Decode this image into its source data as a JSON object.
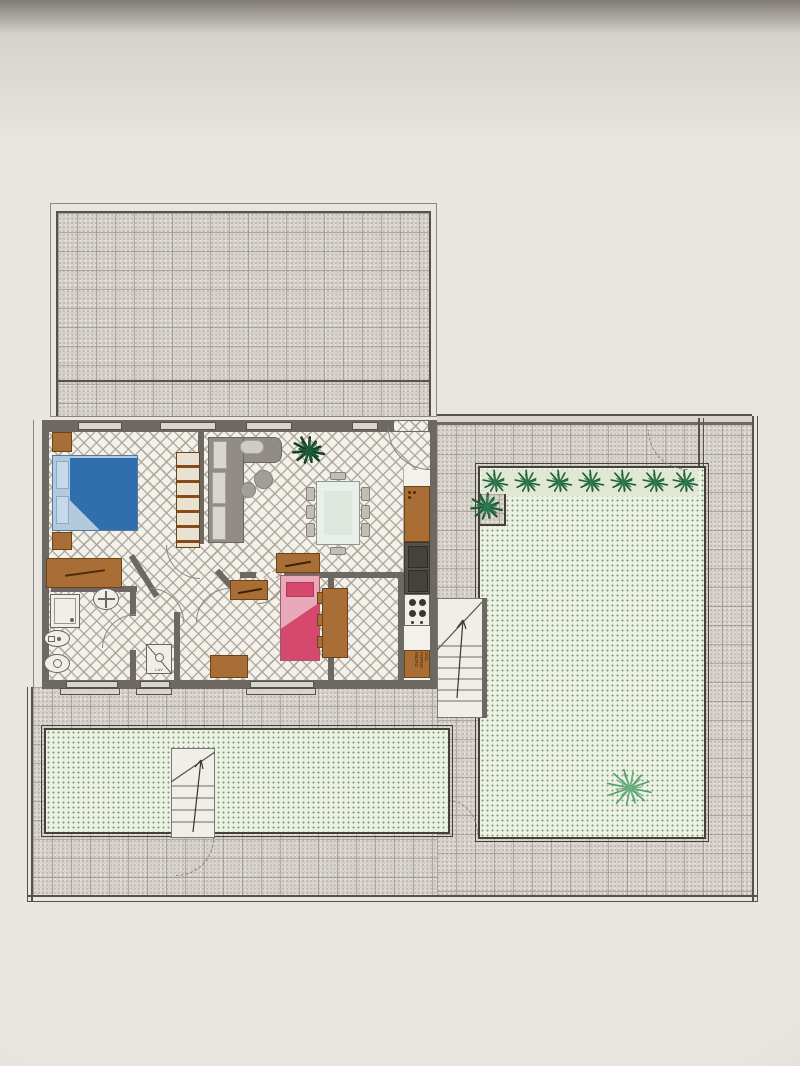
{
  "plan": {
    "washing_machine_label": "LAV",
    "oven_column_label": "COL. FORNO MICRO"
  },
  "palette": {
    "paper": "#e9e6e1",
    "terrace_tile": "#d5d1ca",
    "floor_lattice": "#f3f1ea",
    "wall": "#6e6862",
    "outline": "#56514b",
    "lawn": "#ecf1e2",
    "lawn_dot": "#57875f",
    "bed_blue": "#2f6fae",
    "bed_blue_light": "#b3c9de",
    "bed_pink": "#d6496e",
    "bed_pink_light": "#e9a9ba",
    "wood": "#a96e35",
    "sofa_gray": "#918d86",
    "cushion": "#d9d6cf",
    "appliance_dark": "#55524c",
    "plant_dark": "#1d5c38",
    "plant_mid": "#2e7a4e",
    "plant_light": "#53a06e"
  },
  "objects": [
    "upper tiled terrace",
    "apartment floor plan",
    "double bed with blue bedding",
    "nightstands and dresser",
    "wardrobe with hanger rail",
    "L-shaped sofa with round side tables",
    "indoor plant",
    "dining table with eight chairs",
    "kitchen counter with sink, hob and oven column",
    "bathroom: shower, washbasin, bidet, toilet",
    "washing machine",
    "single bed with pink bedding",
    "two desks and wardrobe",
    "two staircases with direction arrows",
    "walled garden with lawn, hedge row and trees",
    "tiled walkways and gate swing arcs"
  ]
}
